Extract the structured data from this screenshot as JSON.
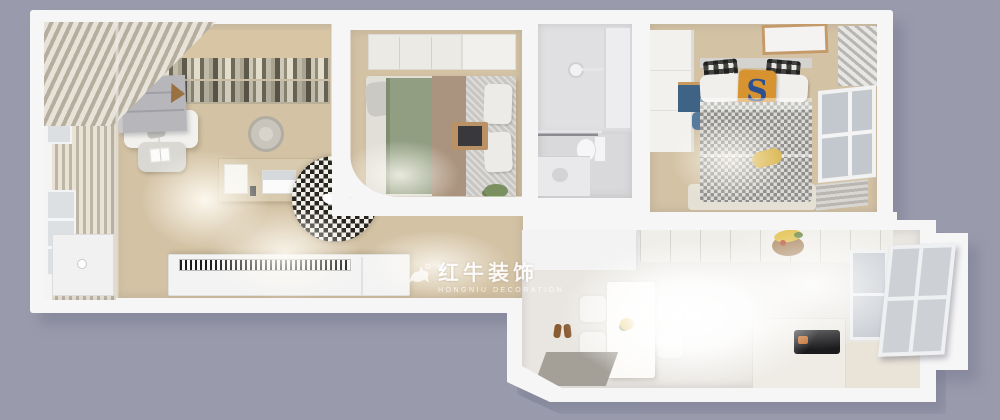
{
  "meta": {
    "scene": "3D top-down apartment floor plan render",
    "view": "bird's-eye dollhouse view"
  },
  "palette": {
    "background": "#999aab",
    "wall": "#f6f6f7",
    "wood_floor": "#d3c2a4",
    "bookshelf": "#b2a78d",
    "bed_green": "#919e82",
    "bed_taupe": "#ab947f",
    "kids_pillow_orange": "#d6932f",
    "kids_pillow_letter_blue": "#2d4f90",
    "desk_blue": "#3e6385",
    "cooktop_black": "#1b1b1e",
    "banana_yellow": "#e2c14c",
    "watermark_white": "#ffffff"
  },
  "watermark": {
    "logo": "bull-icon",
    "registered_mark": "®",
    "brand": "红牛装饰",
    "brand_latin": "HONGNIU DECORATION"
  },
  "kids_room": {
    "pillow_letter": "S"
  },
  "rooms": [
    {
      "id": "balcony",
      "features": [
        "slatted roof",
        "window wall",
        "storage cabinet",
        "gray cabinet"
      ]
    },
    {
      "id": "study-lounge",
      "features": [
        "bookshelf wall",
        "sofa",
        "coffee table with open book",
        "desk with laptop",
        "office chair",
        "houndstooth round rug",
        "white cat",
        "piano sideboard"
      ]
    },
    {
      "id": "master-bedroom",
      "features": [
        "wardrobe",
        "bed with green and taupe bedding",
        "gray duvet",
        "pillows",
        "breakfast tray with laptop",
        "plant"
      ]
    },
    {
      "id": "bathroom",
      "features": [
        "shower head",
        "glass partition",
        "wall shelf",
        "toilet",
        "sink counter"
      ]
    },
    {
      "id": "kids-bedroom",
      "features": [
        "white wardrobe",
        "blue desk and chair",
        "houndstooth blanket bed",
        "letter pillow",
        "buffalo-plaid pillows",
        "window",
        "radiator",
        "lattice screen",
        "ceiling panel"
      ]
    },
    {
      "id": "dining-kitchen",
      "features": [
        "dining table",
        "four chairs",
        "flower posy",
        "entry mat",
        "slippers",
        "kitchen counters",
        "island with cooktop",
        "fruit bowl with bananas",
        "glazed entry door"
      ]
    }
  ]
}
